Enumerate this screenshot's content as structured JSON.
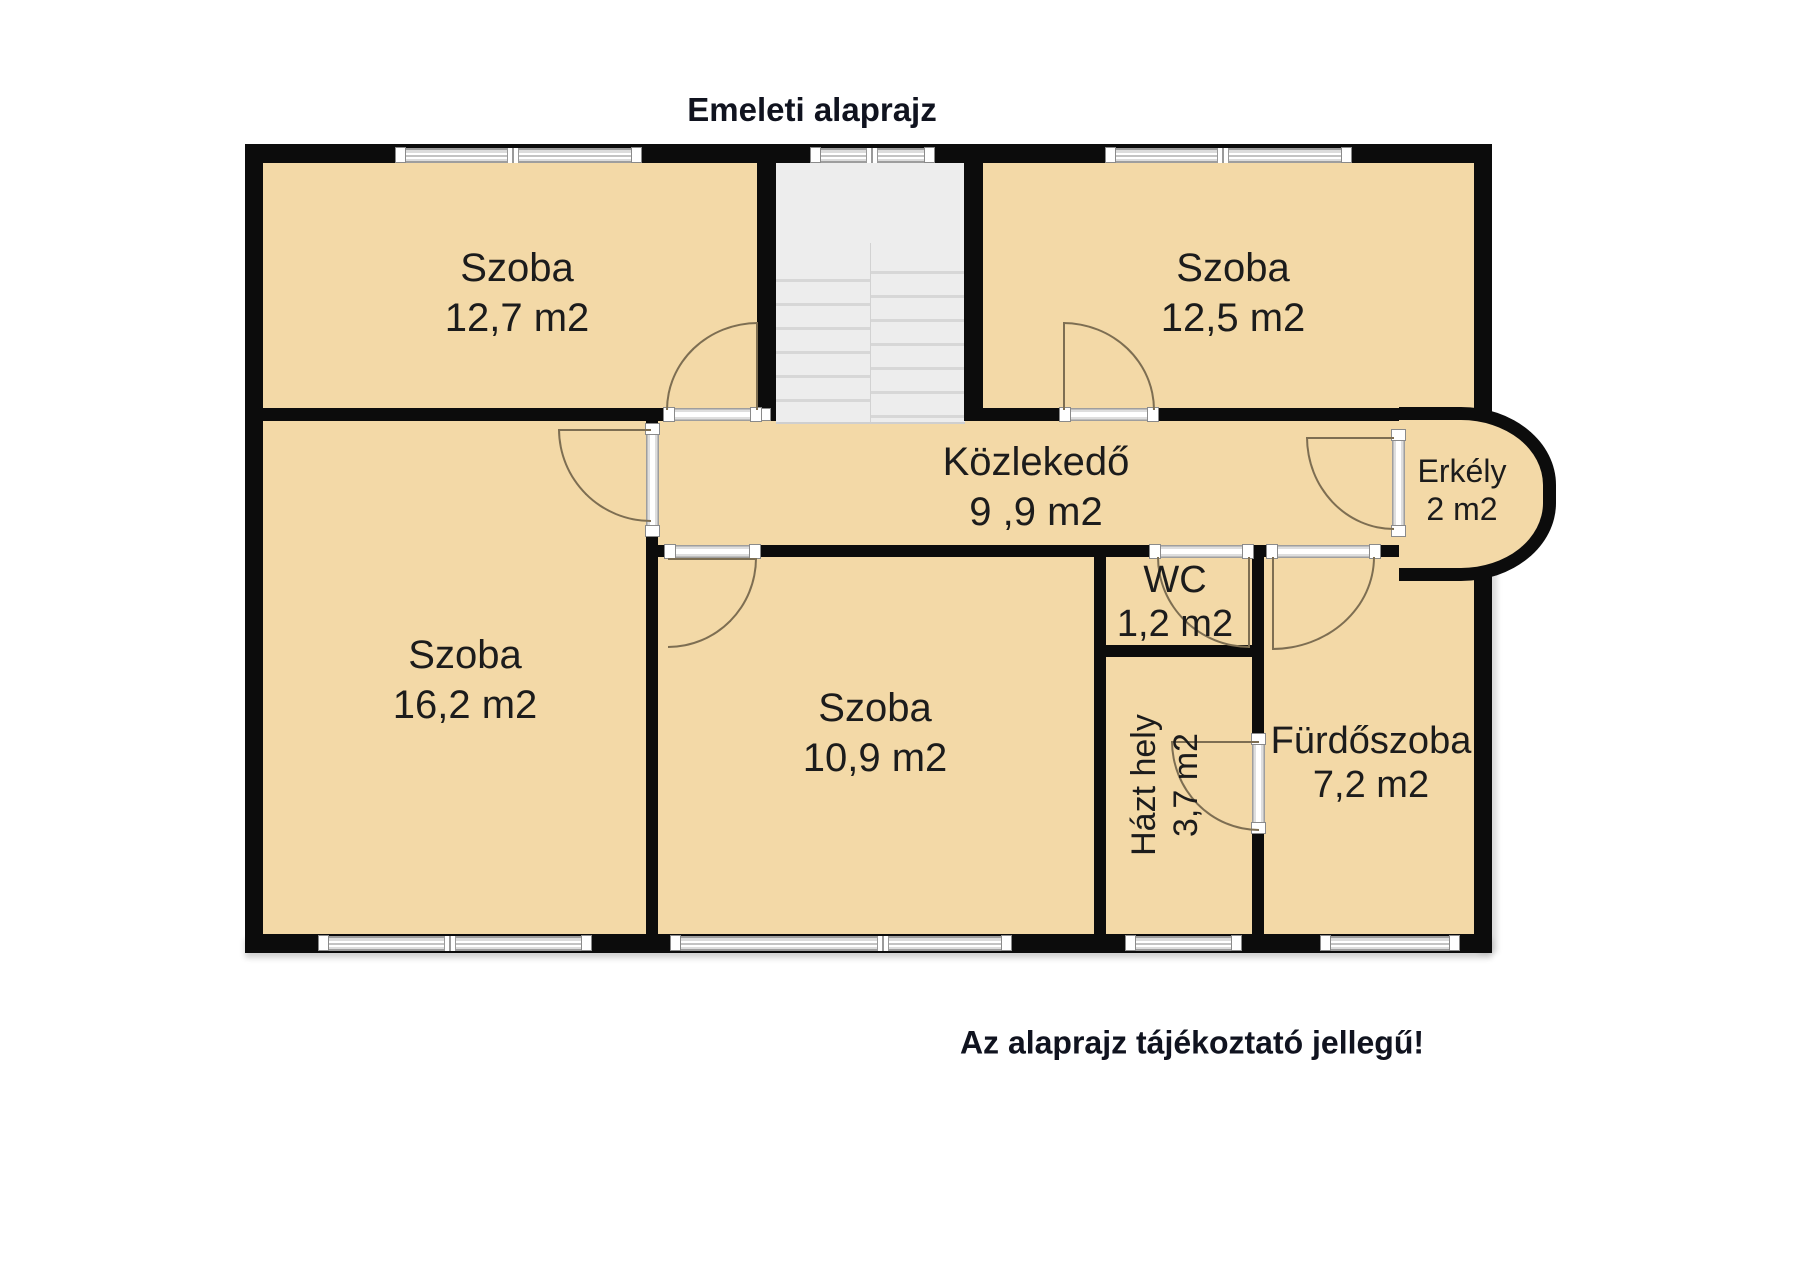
{
  "title": "Emeleti alaprajz",
  "footer": "Az alaprajz tájékoztató jellegű!",
  "rooms": [
    {
      "id": "szoba-127",
      "name": "Szoba",
      "area": "12,7 m2"
    },
    {
      "id": "szoba-125",
      "name": "Szoba",
      "area": "12,5 m2"
    },
    {
      "id": "kozlekedo",
      "name": "Közlekedő",
      "area": "9 ,9 m2"
    },
    {
      "id": "erkely",
      "name": "Erkély",
      "area": "2 m2"
    },
    {
      "id": "szoba-162",
      "name": "Szoba",
      "area": "16,2 m2"
    },
    {
      "id": "szoba-109",
      "name": "Szoba",
      "area": "10,9 m2"
    },
    {
      "id": "wc",
      "name": "WC",
      "area": "1,2 m2"
    },
    {
      "id": "hazt-hely",
      "name": "Házt hely",
      "area": "3,7 m2"
    },
    {
      "id": "furdoszoba",
      "name": "Fürdőszoba",
      "area": "7,2 m2"
    }
  ],
  "colors": {
    "floor": "#f3d9a7",
    "wall": "#0c0c0c",
    "stairwell": "#ededed",
    "window": "#c9c9c9",
    "door_swing": "#7d6e52",
    "text": "#10131f",
    "background": "#ffffff"
  }
}
